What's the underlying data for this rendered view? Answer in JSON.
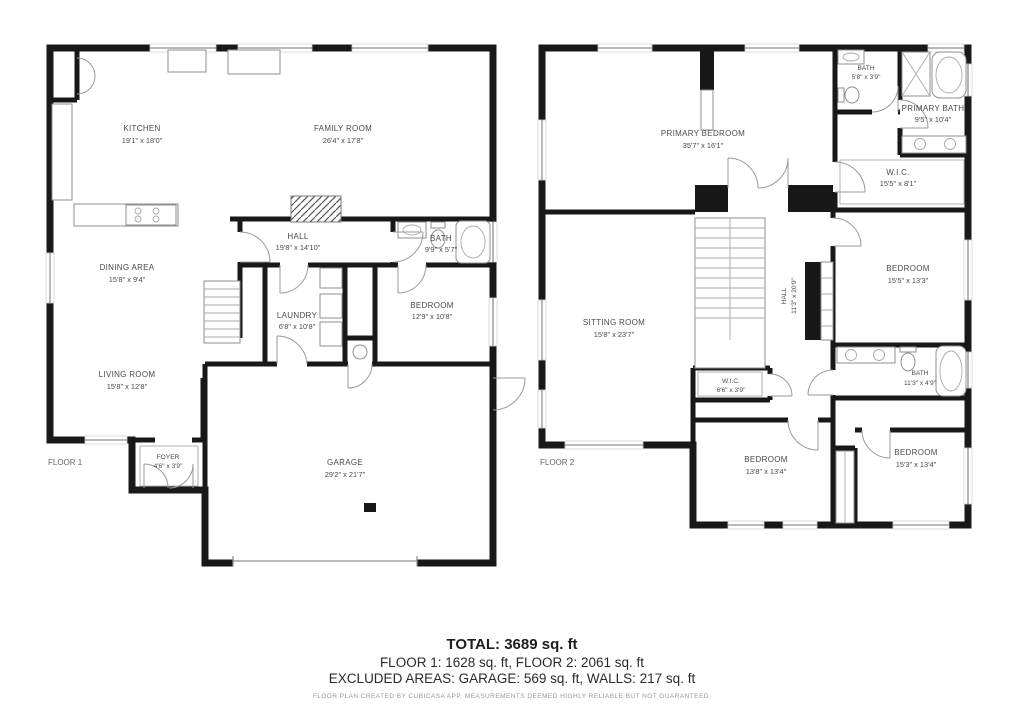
{
  "floor1": {
    "label": "FLOOR 1",
    "rooms": {
      "kitchen": {
        "name": "KITCHEN",
        "dims": "19'1\" x 18'0\""
      },
      "family_room": {
        "name": "FAMILY ROOM",
        "dims": "26'4\" x 17'8\""
      },
      "hall": {
        "name": "HALL",
        "dims": "19'8\" x 14'10\""
      },
      "bath": {
        "name": "BATH",
        "dims": "9'9\" x 5'7\""
      },
      "dining_area": {
        "name": "DINING AREA",
        "dims": "15'8\" x 9'4\""
      },
      "laundry": {
        "name": "LAUNDRY",
        "dims": "6'8\" x 10'8\""
      },
      "bedroom": {
        "name": "BEDROOM",
        "dims": "12'9\" x 10'8\""
      },
      "living_room": {
        "name": "LIVING ROOM",
        "dims": "15'8\" x 12'8\""
      },
      "foyer": {
        "name": "FOYER",
        "dims": "4'6\" x 3'9\""
      },
      "garage": {
        "name": "GARAGE",
        "dims": "29'2\" x 21'7\""
      }
    }
  },
  "floor2": {
    "label": "FLOOR 2",
    "rooms": {
      "primary_bedroom": {
        "name": "PRIMARY BEDROOM",
        "dims": "35'7\" x 16'1\""
      },
      "bath_top": {
        "name": "BATH",
        "dims": "5'8\" x 3'9\""
      },
      "primary_bath": {
        "name": "PRIMARY BATH",
        "dims": "9'5\" x 10'4\""
      },
      "wic": {
        "name": "W.I.C.",
        "dims": "15'5\" x 8'1\""
      },
      "bedroom_right": {
        "name": "BEDROOM",
        "dims": "15'5\" x 13'3\""
      },
      "sitting_room": {
        "name": "SITTING ROOM",
        "dims": "15'8\" x 23'7\""
      },
      "hall": {
        "name": "HALL",
        "dims": "11'3\" x 20'9\""
      },
      "bath_mid": {
        "name": "BATH",
        "dims": "11'3\" x 4'9\""
      },
      "wic_small": {
        "name": "W.I.C.",
        "dims": "6'6\" x 3'9\""
      },
      "bedroom_bottom_left": {
        "name": "BEDROOM",
        "dims": "13'8\" x 13'4\""
      },
      "bedroom_bottom_right": {
        "name": "BEDROOM",
        "dims": "15'3\" x 13'4\""
      }
    }
  },
  "summary": {
    "total": "TOTAL: 3689 sq. ft",
    "floors": "FLOOR 1: 1628 sq. ft, FLOOR 2: 2061 sq. ft",
    "excluded": "EXCLUDED AREAS: GARAGE: 569 sq. ft, WALLS: 217 sq. ft",
    "disclaimer": "FLOOR PLAN CREATED BY CUBICASA APP. MEASUREMENTS DEEMED HIGHLY RELIABLE BUT NOT GUARANTEED."
  }
}
